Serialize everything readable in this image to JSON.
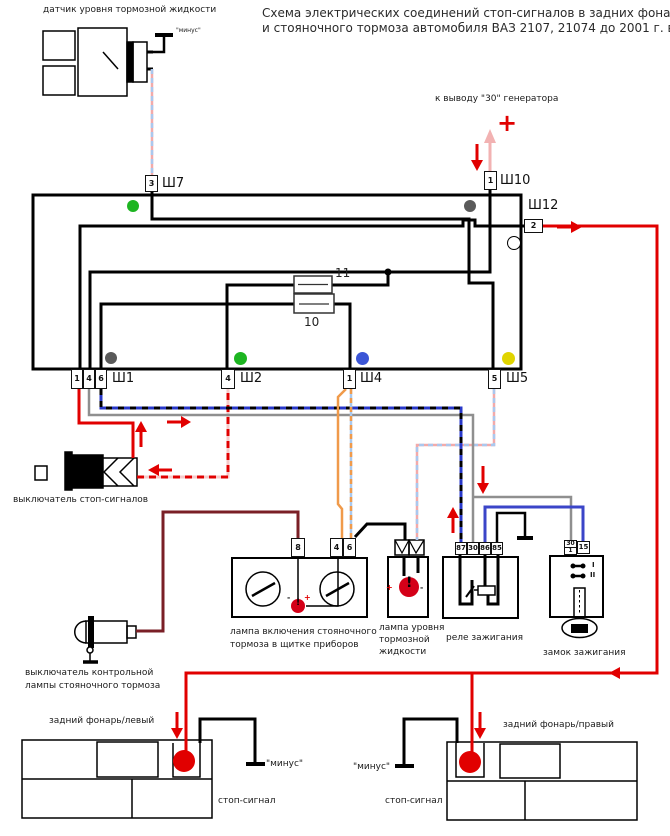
{
  "title": {
    "line1": "Схема электрических соединений стоп-сигналов в задних фонарях",
    "line2": "и стояночного тормоза автомобиля ВАЗ 2107, 21074 до 2001 г. в."
  },
  "annotations": {
    "generator_terminal": "к выводу \"30\" генератора",
    "plus": "+",
    "minus": "\"минус\"",
    "plus_small": "+",
    "minus_small": "-",
    "exclaim": "!",
    "ignition_mark_1": "I",
    "ignition_mark_2": "II"
  },
  "component_labels": {
    "fluid_sensor": "датчик уровня тормозной жидкости",
    "brake_switch": "выключатель стоп-сигналов",
    "cluster_line1": "лампа включения стояночного",
    "cluster_line2": "тормоза в щитке приборов",
    "fluid_lamp_line1": "лампа уровня",
    "fluid_lamp_line2": "тормозной",
    "fluid_lamp_line3": "жидкости",
    "ignition_relay": "реле зажигания",
    "ignition_lock": "замок зажигания",
    "parking_switch_line1": "выключатель контрольной",
    "parking_switch_line2": "лампы стояночного тормоза",
    "rear_lamp_left": "задний фонарь/левый",
    "rear_lamp_right": "задний фонарь/правый",
    "stop_signal_left": "стоп-сигнал",
    "stop_signal_right": "стоп-сигнал",
    "fuse_10": "10",
    "fuse_11": "11"
  },
  "connector_labels": [
    {
      "text": "Ш7",
      "x": 162,
      "y": 176
    },
    {
      "text": "Ш10",
      "x": 500,
      "y": 173
    },
    {
      "text": "Ш12",
      "x": 528,
      "y": 198
    },
    {
      "text": "Ш1",
      "x": 112,
      "y": 371
    },
    {
      "text": "Ш2",
      "x": 240,
      "y": 371
    },
    {
      "text": "Ш4",
      "x": 360,
      "y": 371
    },
    {
      "text": "Ш5",
      "x": 506,
      "y": 371
    }
  ],
  "pins": [
    {
      "label": "3",
      "x": 145,
      "y": 175,
      "w": 13,
      "h": 17
    },
    {
      "label": "1",
      "x": 484,
      "y": 171,
      "w": 13,
      "h": 19
    },
    {
      "label": "2",
      "x": 524,
      "y": 219,
      "w": 19,
      "h": 14
    },
    {
      "label": "1",
      "x": 71,
      "y": 369,
      "w": 12,
      "h": 20
    },
    {
      "label": "4",
      "x": 83,
      "y": 369,
      "w": 12,
      "h": 20
    },
    {
      "label": "6",
      "x": 95,
      "y": 369,
      "w": 12,
      "h": 20
    },
    {
      "label": "4",
      "x": 221,
      "y": 369,
      "w": 14,
      "h": 20
    },
    {
      "label": "1",
      "x": 343,
      "y": 369,
      "w": 13,
      "h": 20
    },
    {
      "label": "5",
      "x": 488,
      "y": 369,
      "w": 13,
      "h": 20
    },
    {
      "label": "8",
      "x": 291,
      "y": 538,
      "w": 14,
      "h": 19
    },
    {
      "label": "4",
      "x": 330,
      "y": 538,
      "w": 13,
      "h": 19
    },
    {
      "label": "6",
      "x": 343,
      "y": 538,
      "w": 13,
      "h": 19
    },
    {
      "label": "87",
      "x": 455,
      "y": 542,
      "w": 12,
      "h": 13,
      "fs": 7
    },
    {
      "label": "30",
      "x": 467,
      "y": 542,
      "w": 12,
      "h": 13,
      "fs": 7
    },
    {
      "label": "86",
      "x": 479,
      "y": 542,
      "w": 12,
      "h": 13,
      "fs": 7
    },
    {
      "label": "85",
      "x": 491,
      "y": 542,
      "w": 12,
      "h": 13,
      "fs": 7
    },
    {
      "label": "30",
      "label2": "1",
      "x": 564,
      "y": 540,
      "w": 13,
      "h": 15,
      "fs": 6
    },
    {
      "label": "15",
      "x": 577,
      "y": 541,
      "w": 13,
      "h": 13,
      "fs": 7
    }
  ],
  "wire_color_dots": [
    {
      "name": "green-dot-sh7",
      "color": "#1db521",
      "x": 133,
      "y": 206,
      "r": 6
    },
    {
      "name": "gray-dot-sh10",
      "color": "#5a5a5a",
      "x": 470,
      "y": 206,
      "r": 6
    },
    {
      "name": "white-dot-sh12",
      "color": "#ffffff",
      "x": 513,
      "y": 242,
      "r": 6,
      "outline": true
    },
    {
      "name": "gray-dot-sh1",
      "color": "#5a5a5a",
      "x": 111,
      "y": 358,
      "r": 6
    },
    {
      "name": "green-dot-sh2",
      "color": "#1db521",
      "x": 240,
      "y": 358,
      "r": 6.5
    },
    {
      "name": "blue-dot-sh4",
      "color": "#3b55d6",
      "x": 362,
      "y": 358,
      "r": 6.5
    },
    {
      "name": "yellow-dot-sh5",
      "color": "#e0d400",
      "x": 508,
      "y": 358,
      "r": 6.5
    }
  ],
  "wire_colors": {
    "stop_feed_red": "#e10000",
    "parking_lamp_dark_red": "#7a1f26",
    "ignition30_gray": "#8f8f8f",
    "ignition15_blue": "#3b45c8",
    "blue_black_dashed": "#2838c8",
    "orange": "#f09a4a",
    "orange_blue_dashed": "#a8c8ee",
    "pink_blue_dashed": "#f2aaaa",
    "red_white_dashed": "#f6cbcb",
    "ground_black": "#000000"
  }
}
